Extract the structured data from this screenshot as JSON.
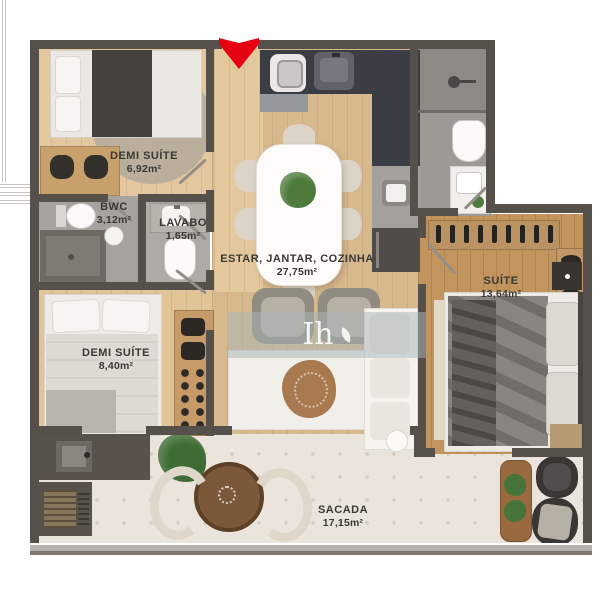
{
  "rooms": {
    "demi_suite_1": {
      "label": "DEMI SUÍTE",
      "area": "6,92m²"
    },
    "bwc": {
      "label": "BWC",
      "area": "3,12m²"
    },
    "lavabo": {
      "label": "LAVABO",
      "area": "1,65m²"
    },
    "living": {
      "label": "ESTAR, JANTAR, COZINHA",
      "area": "27,75m²"
    },
    "suite": {
      "label": "SUÍTE",
      "area": "13,64m²"
    },
    "demi_suite_2": {
      "label": "DEMI SUÍTE",
      "area": "8,40m²"
    },
    "sacada": {
      "label": "SACADA",
      "area": "17,15m²"
    }
  },
  "watermark": {
    "logo_text": "Ih"
  },
  "colors": {
    "wall": "#56504a",
    "entrance_arrow": "#e60012",
    "wood_light": "#ddbb90",
    "wood_suite": "#c2955e",
    "bathroom_gray": "#9d9a96",
    "balcony_floor": "#eae4dd",
    "kitchen_counter": "#3a3d43",
    "label_text": "#3a3834"
  }
}
